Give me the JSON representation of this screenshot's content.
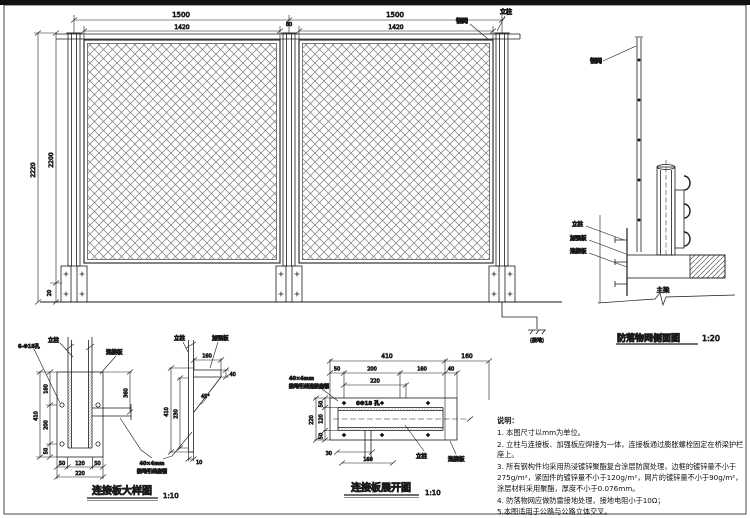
{
  "sheet": {
    "bg": "#ffffff",
    "line_color": "#1b1b1b"
  },
  "elevation": {
    "dims": {
      "span_left": "1500",
      "span_right": "1500",
      "panel_left": "1420",
      "panel_right": "1420",
      "post_width": "80",
      "total_height": "2220",
      "mesh_height": "2200",
      "bottom_gap": "20"
    },
    "labels": {
      "mesh": "钢网",
      "post": "立柱",
      "ground": "(接地)"
    }
  },
  "side_view": {
    "title": "防落物网侧面图",
    "scale": "1:20",
    "labels": {
      "mesh": "钢网",
      "post": "立柱",
      "stiffener": "加强板",
      "plate": "连接板",
      "beam": "主梁"
    }
  },
  "plate_detail": {
    "title": "连接板大样图",
    "scale": "1:10",
    "front": {
      "labels": {
        "post": "立柱",
        "plate": "连接板",
        "holes": "6-Φ18孔"
      },
      "dims": {
        "h_total": "410",
        "h_top": "160",
        "h_mid": "200",
        "h_bot": "50",
        "w_left": "50",
        "w_mid": "120",
        "w_right": "50",
        "w_total": "220",
        "strap_drop": "360"
      }
    },
    "side": {
      "labels": {
        "post": "立柱",
        "stiffener": "加强板"
      },
      "dims": {
        "flange_len": "160",
        "flange_w": "40",
        "angle": "45°",
        "h_total": "410",
        "h_inner": "230",
        "thickness": "10"
      }
    },
    "strap_note": {
      "line1": "40×4mm",
      "line2": "接地引线扁钢"
    }
  },
  "plate_development": {
    "title": "连接板展开图",
    "scale": "1:10",
    "labels": {
      "holes": "6Φ18 孔",
      "post": "立柱",
      "plate": "连接板"
    },
    "strap_note": {
      "line1": "40×4mm",
      "line2": "接地引线连接扁钢"
    },
    "dims": {
      "len_main": "410",
      "len_flange": "160",
      "seg1": "50",
      "seg2": "200",
      "seg3": "160",
      "seg4": "40",
      "seg_220": "220",
      "side_total": "220",
      "side1": "50",
      "side2": "120",
      "side3": "50",
      "strap_w": "30",
      "strap_len": "160"
    }
  },
  "notes": {
    "title": "说明：",
    "items": [
      "1. 本图尺寸以mm为单位。",
      "2. 立柱与连接板、加强板应焊接为一体，连接板通过膨胀螺栓固定在桥梁护栏座上。",
      "3. 所有钢构件均采用热浸镀锌聚酯复合涂层防腐处理，边框的镀锌量不小于275g/m²，紧固件的镀锌量不小于120g/m²，网片的镀锌量不小于90g/m²，涂层材料采用聚酯，厚度不小于0.076mm。",
      "4. 防落物网应做防雷接地处理，接地电阻小于10Ω；",
      "5.本图适用于公路与公路立体交叉。"
    ]
  }
}
